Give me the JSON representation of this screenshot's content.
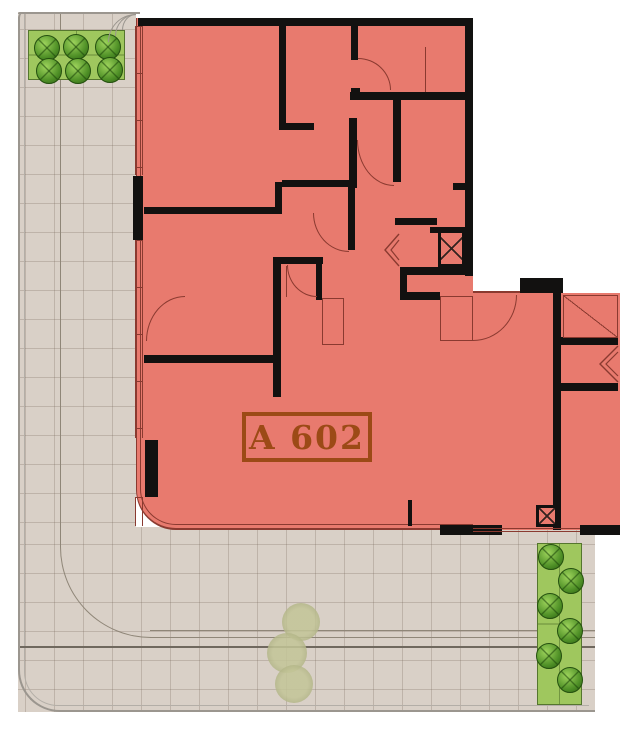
{
  "unit": {
    "label": "A 602"
  },
  "colors": {
    "salmon": "#e87a6e",
    "redline": "#8a3a30",
    "wall": "#121110",
    "labelcol": "#9c4a16",
    "ground": "#d9d0c7",
    "grid": "rgba(120,105,90,0.28)",
    "bound": "#9b968f",
    "bound2": "#b3aea7",
    "plant": "#9fc75e",
    "plantbrd": "#55762e",
    "path": "#8f8678",
    "pathdark": "#6f685e"
  },
  "geometry": {
    "ground_rects": [
      {
        "x": 18,
        "y": 12,
        "w": 118,
        "h": 700
      },
      {
        "x": 18,
        "y": 527,
        "w": 577,
        "h": 185
      }
    ],
    "unit_rects": [
      {
        "x": 136,
        "y": 18,
        "w": 337,
        "h": 512,
        "main": true
      },
      {
        "x": 473,
        "y": 293,
        "w": 147,
        "h": 237,
        "main": false
      }
    ],
    "walls": [
      [
        138,
        18,
        334,
        8
      ],
      [
        465,
        18,
        8,
        258
      ],
      [
        400,
        267,
        73,
        8
      ],
      [
        520,
        278,
        43,
        15
      ],
      [
        553,
        286,
        8,
        244
      ],
      [
        561,
        337,
        57,
        8
      ],
      [
        561,
        383,
        57,
        8
      ],
      [
        440,
        525,
        62,
        10
      ],
      [
        580,
        525,
        40,
        10
      ],
      [
        408,
        500,
        4,
        26
      ],
      [
        133,
        176,
        10,
        64
      ],
      [
        145,
        440,
        13,
        57
      ],
      [
        279,
        24,
        7,
        106
      ],
      [
        279,
        123,
        35,
        7
      ],
      [
        351,
        24,
        7,
        36
      ],
      [
        351,
        88,
        9,
        10
      ],
      [
        350,
        92,
        122,
        8
      ],
      [
        393,
        97,
        8,
        85
      ],
      [
        395,
        218,
        42,
        7
      ],
      [
        282,
        180,
        73,
        7
      ],
      [
        453,
        183,
        19,
        7
      ],
      [
        349,
        118,
        8,
        70
      ],
      [
        348,
        187,
        7,
        63
      ],
      [
        144,
        207,
        131,
        7
      ],
      [
        275,
        182,
        7,
        32
      ],
      [
        273,
        257,
        50,
        7
      ],
      [
        273,
        257,
        8,
        140
      ],
      [
        144,
        355,
        137,
        8
      ],
      [
        316,
        264,
        6,
        36
      ],
      [
        430,
        227,
        35,
        6
      ],
      [
        400,
        267,
        7,
        33
      ],
      [
        400,
        292,
        40,
        8
      ]
    ],
    "windows": [
      [
        135,
        26,
        8,
        149
      ],
      [
        135,
        240,
        8,
        198
      ],
      [
        135,
        497,
        8,
        29
      ]
    ],
    "arcs": [
      {
        "x": 358,
        "y": 58,
        "w": 33,
        "h": 32,
        "c": "tr"
      },
      {
        "x": 357,
        "y": 140,
        "w": 37,
        "h": 46,
        "c": "bl"
      },
      {
        "x": 313,
        "y": 213,
        "w": 36,
        "h": 39,
        "c": "bl"
      },
      {
        "x": 287,
        "y": 265,
        "w": 30,
        "h": 32,
        "c": "bl"
      },
      {
        "x": 146,
        "y": 296,
        "w": 39,
        "h": 45,
        "c": "tl"
      },
      {
        "x": 473,
        "y": 295,
        "w": 44,
        "h": 46,
        "c": "br"
      },
      {
        "x": 108,
        "y": 14,
        "w": 28,
        "h": 28,
        "c": "tl",
        "gray": true
      },
      {
        "x": 115,
        "y": 14,
        "w": 21,
        "h": 22,
        "c": "tl",
        "gray": true
      },
      {
        "x": 122,
        "y": 14,
        "w": 14,
        "h": 16,
        "c": "tl",
        "gray": true
      }
    ],
    "xboxes": [
      [
        438,
        230,
        27,
        37
      ],
      [
        536,
        505,
        22,
        22
      ]
    ],
    "thin_rects": [
      {
        "x": 563,
        "y": 295,
        "w": 55,
        "h": 43,
        "diag": true
      },
      {
        "x": 440,
        "y": 296,
        "w": 33,
        "h": 45,
        "diag": false
      },
      {
        "x": 322,
        "y": 298,
        "w": 22,
        "h": 47,
        "diag": false
      }
    ],
    "thin_lines": [
      [
        473,
        291,
        47,
        2
      ],
      [
        425,
        47,
        1,
        45
      ],
      [
        286,
        266,
        1,
        31
      ]
    ],
    "double_lines": [
      [
        473,
        528,
        107,
        4
      ]
    ],
    "chevrons": [
      {
        "x": 383,
        "y": 233,
        "w": 17,
        "h": 34
      },
      {
        "x": 598,
        "y": 345,
        "w": 21,
        "h": 38
      }
    ],
    "path_lines": [
      [
        60,
        14,
        1,
        533
      ],
      [
        150,
        630,
        445,
        1
      ],
      [
        150,
        637,
        445,
        1
      ],
      [
        20,
        646,
        575,
        2
      ]
    ],
    "path_curve": {
      "x": 60,
      "y": 547,
      "w": 91,
      "h": 91
    },
    "boundary": {
      "x": 18,
      "y": 12,
      "w": 577,
      "h": 700
    },
    "boundary_inner": {
      "x": 24,
      "y": 12,
      "w": 565,
      "h": 694
    },
    "topline": {
      "x": 18,
      "y": 12,
      "w": 122,
      "h": 2
    },
    "label_box": {
      "x": 242,
      "y": 412,
      "w": 130,
      "h": 50
    }
  },
  "landscape": {
    "planters": [
      {
        "x": 28,
        "y": 30,
        "w": 97,
        "h": 50,
        "trees": [
          [
            47,
            48
          ],
          [
            76,
            47
          ],
          [
            108,
            47
          ],
          [
            49,
            71
          ],
          [
            78,
            71
          ],
          [
            110,
            70
          ]
        ]
      },
      {
        "x": 537,
        "y": 543,
        "w": 45,
        "h": 162,
        "trees": [
          [
            551,
            557
          ],
          [
            571,
            581
          ],
          [
            550,
            606
          ],
          [
            570,
            631
          ],
          [
            549,
            656
          ],
          [
            570,
            680
          ]
        ]
      }
    ],
    "tree_radius": 13,
    "bushes": [
      [
        301,
        622,
        19
      ],
      [
        287,
        653,
        20
      ],
      [
        294,
        684,
        19
      ]
    ]
  }
}
